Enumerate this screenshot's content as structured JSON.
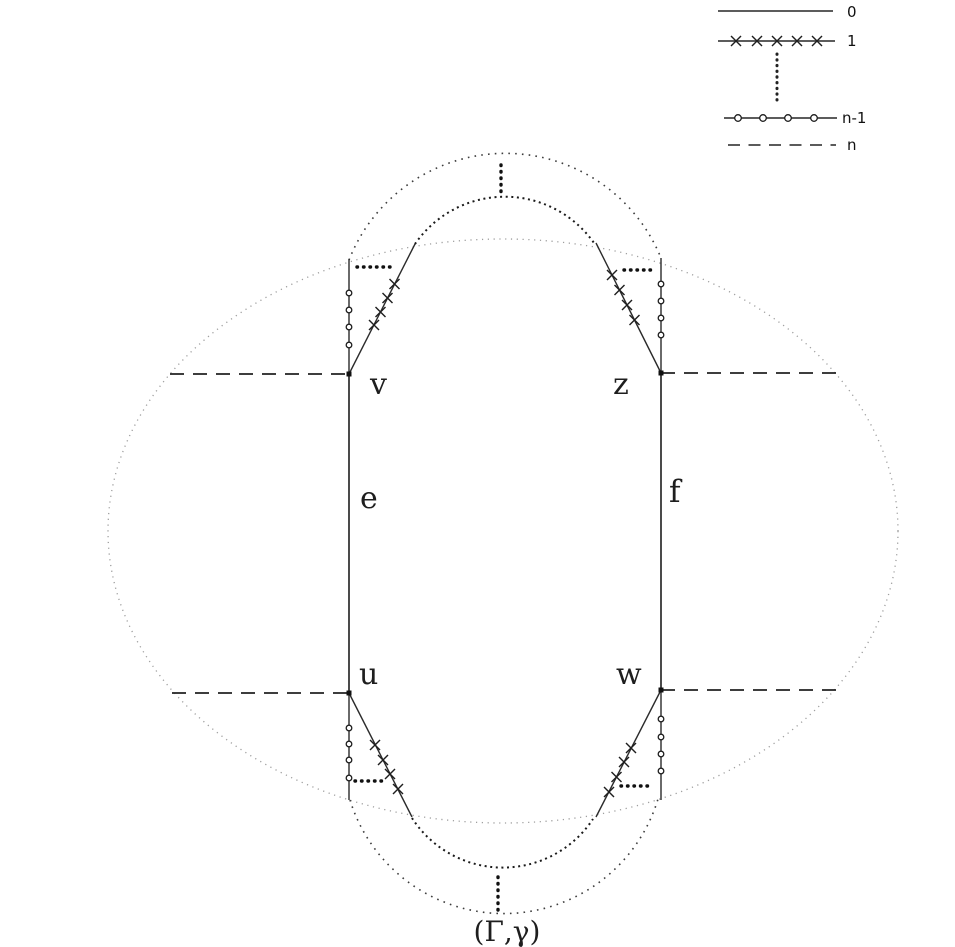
{
  "figure": {
    "caption": "(Γ,γ)",
    "vertices": {
      "v": "v",
      "z": "z",
      "u": "u",
      "w": "w"
    },
    "edges": {
      "e": "e",
      "f": "f"
    }
  },
  "legend": {
    "items": [
      {
        "label": "0",
        "style": "solid"
      },
      {
        "label": "1",
        "style": "x-marks"
      },
      {
        "label": "n-1",
        "style": "circle-marks"
      },
      {
        "label": "n",
        "style": "dashed"
      }
    ]
  },
  "colors": {
    "ink": "#222222",
    "faint_dots": "#9e9e9e",
    "background": "#ffffff"
  }
}
